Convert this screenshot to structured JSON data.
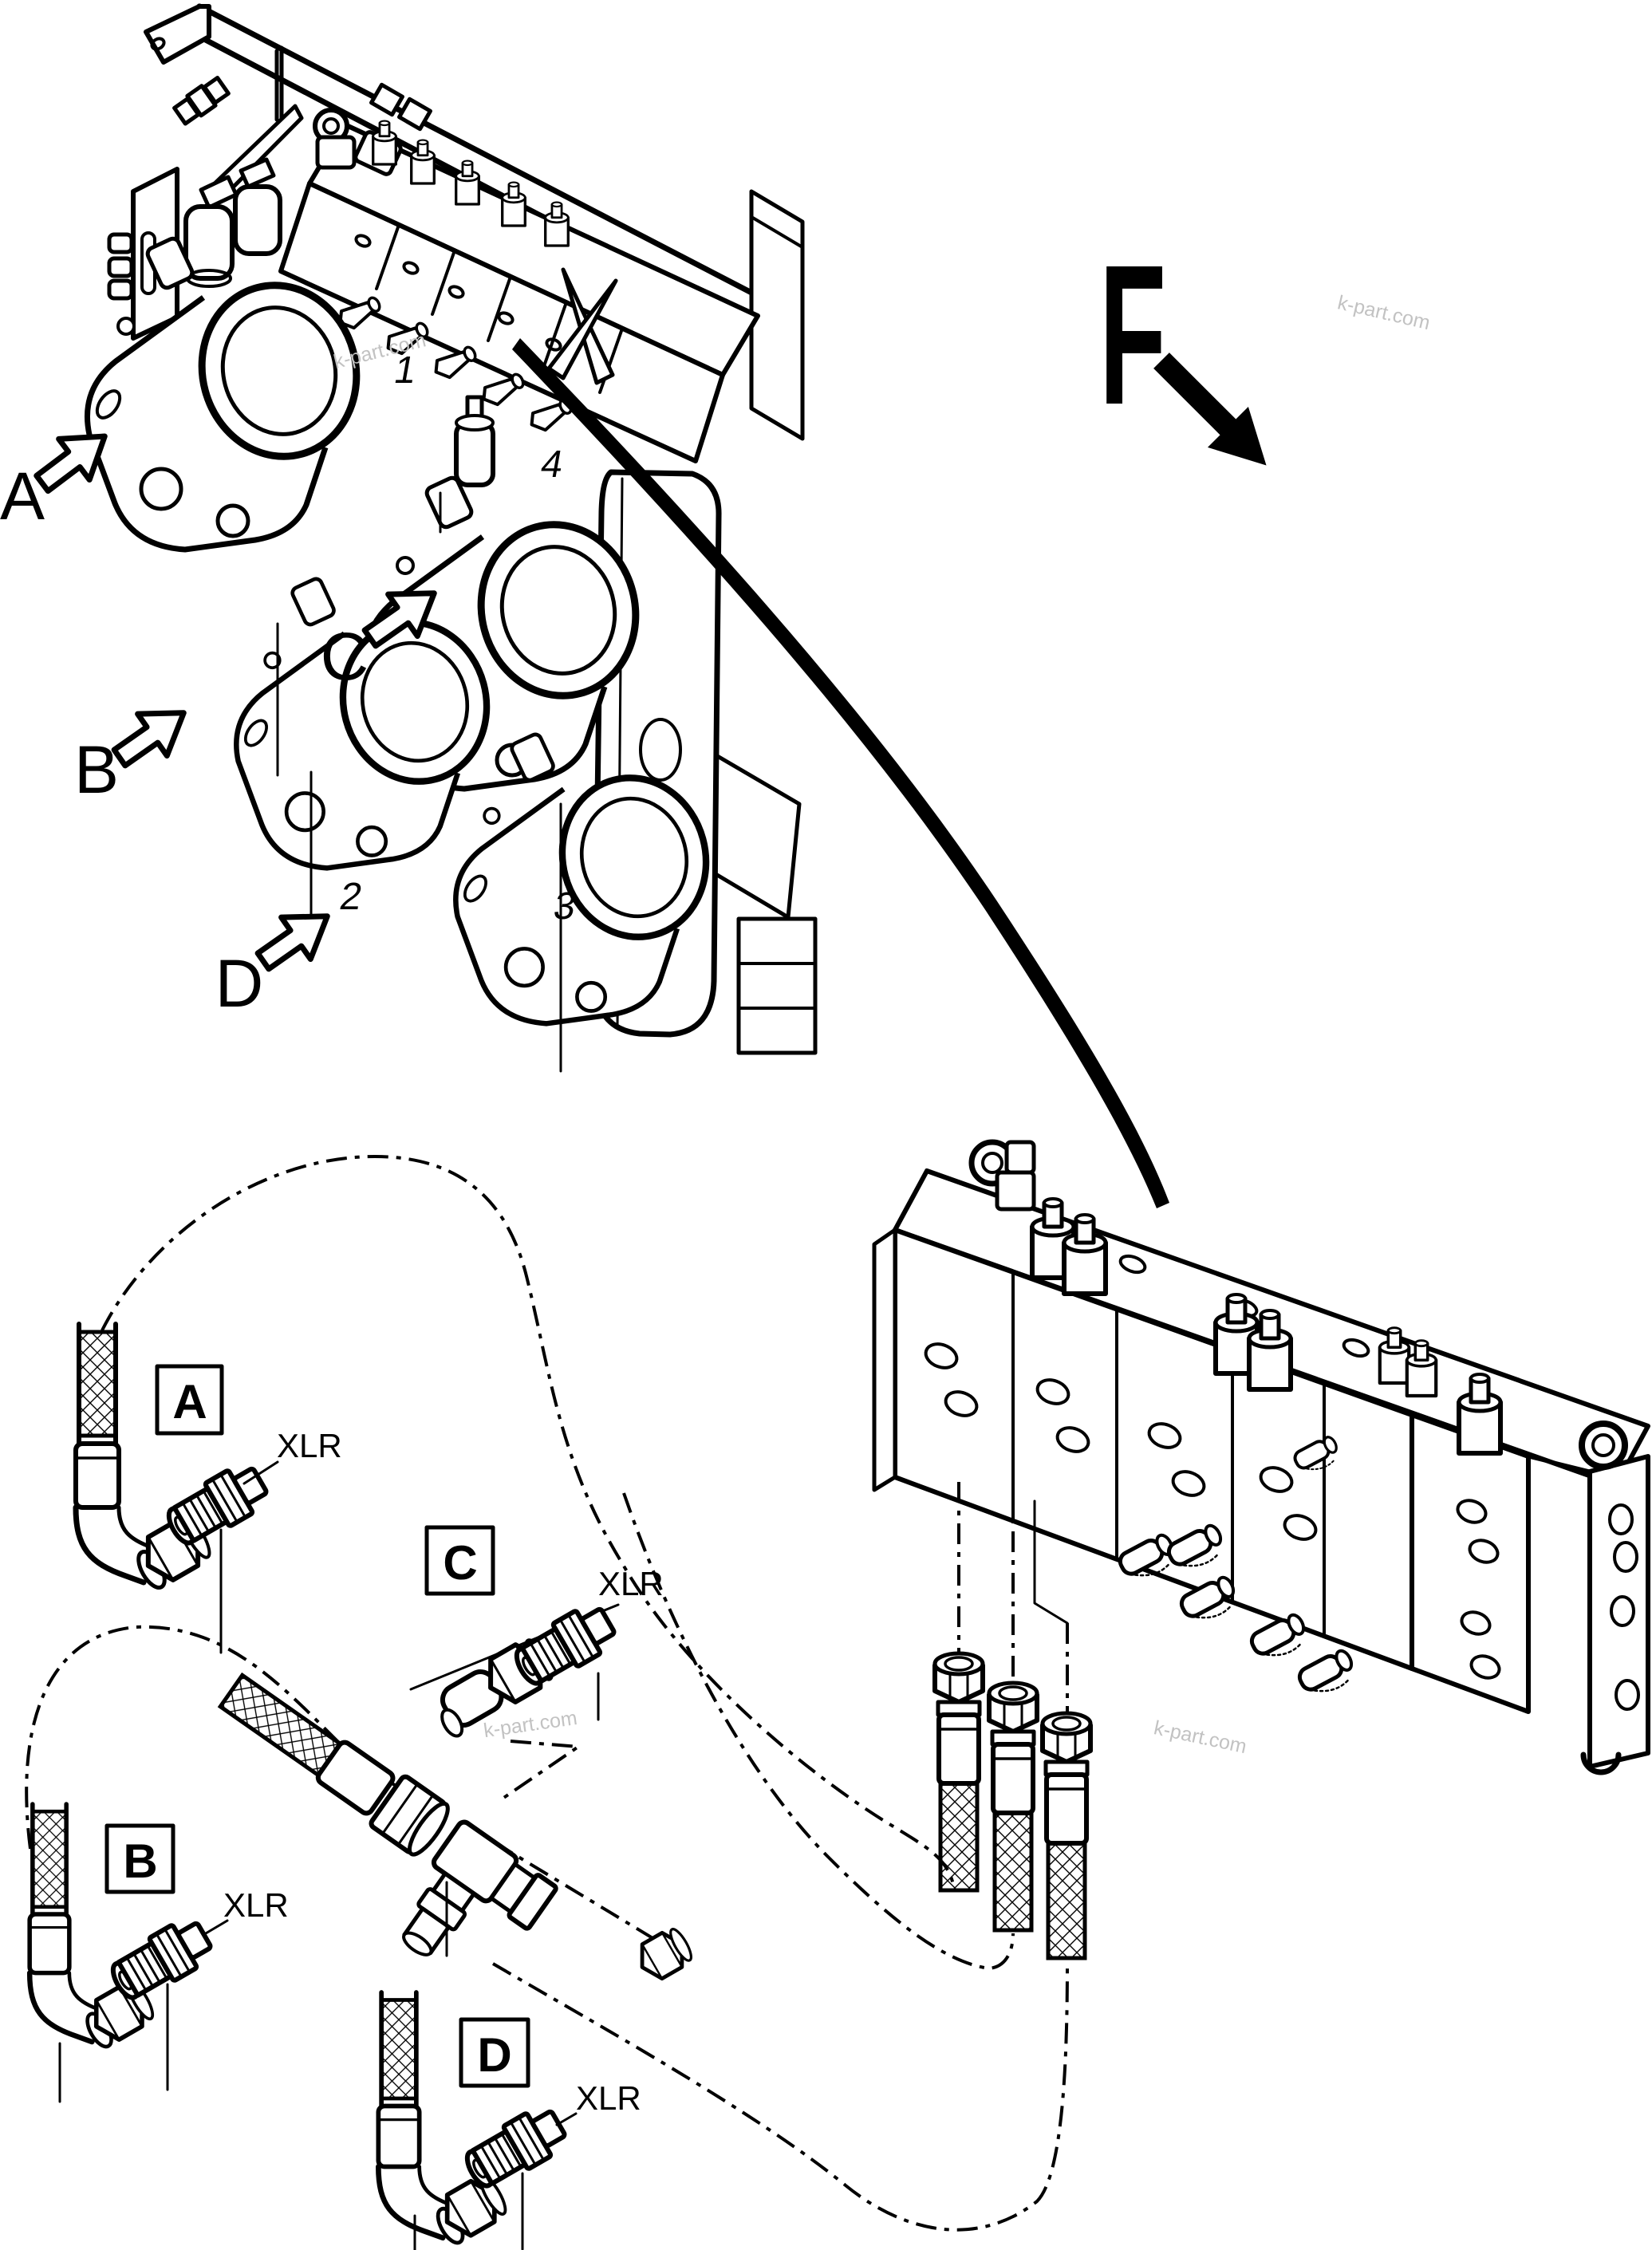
{
  "colors": {
    "ink": "#000000",
    "paper": "#ffffff",
    "watermark": "#c2c2c2"
  },
  "main_view": {
    "direction_label": "F",
    "callouts": [
      {
        "label": "A"
      },
      {
        "label": "B"
      },
      {
        "label": "C"
      },
      {
        "label": "D"
      }
    ],
    "part_numbers": [
      {
        "label": "1"
      },
      {
        "label": "2"
      },
      {
        "label": "3"
      },
      {
        "label": "4"
      }
    ]
  },
  "details": [
    {
      "box_label": "A",
      "fitting_label": "XLR"
    },
    {
      "box_label": "C",
      "fitting_label": "XLR"
    },
    {
      "box_label": "B",
      "fitting_label": "XLR"
    },
    {
      "box_label": "D",
      "fitting_label": "XLR"
    }
  ],
  "watermarks": [
    {
      "text": "k-part.com"
    },
    {
      "text": "k-part.com"
    },
    {
      "text": "k-part.com"
    },
    {
      "text": "k-part.com"
    }
  ]
}
